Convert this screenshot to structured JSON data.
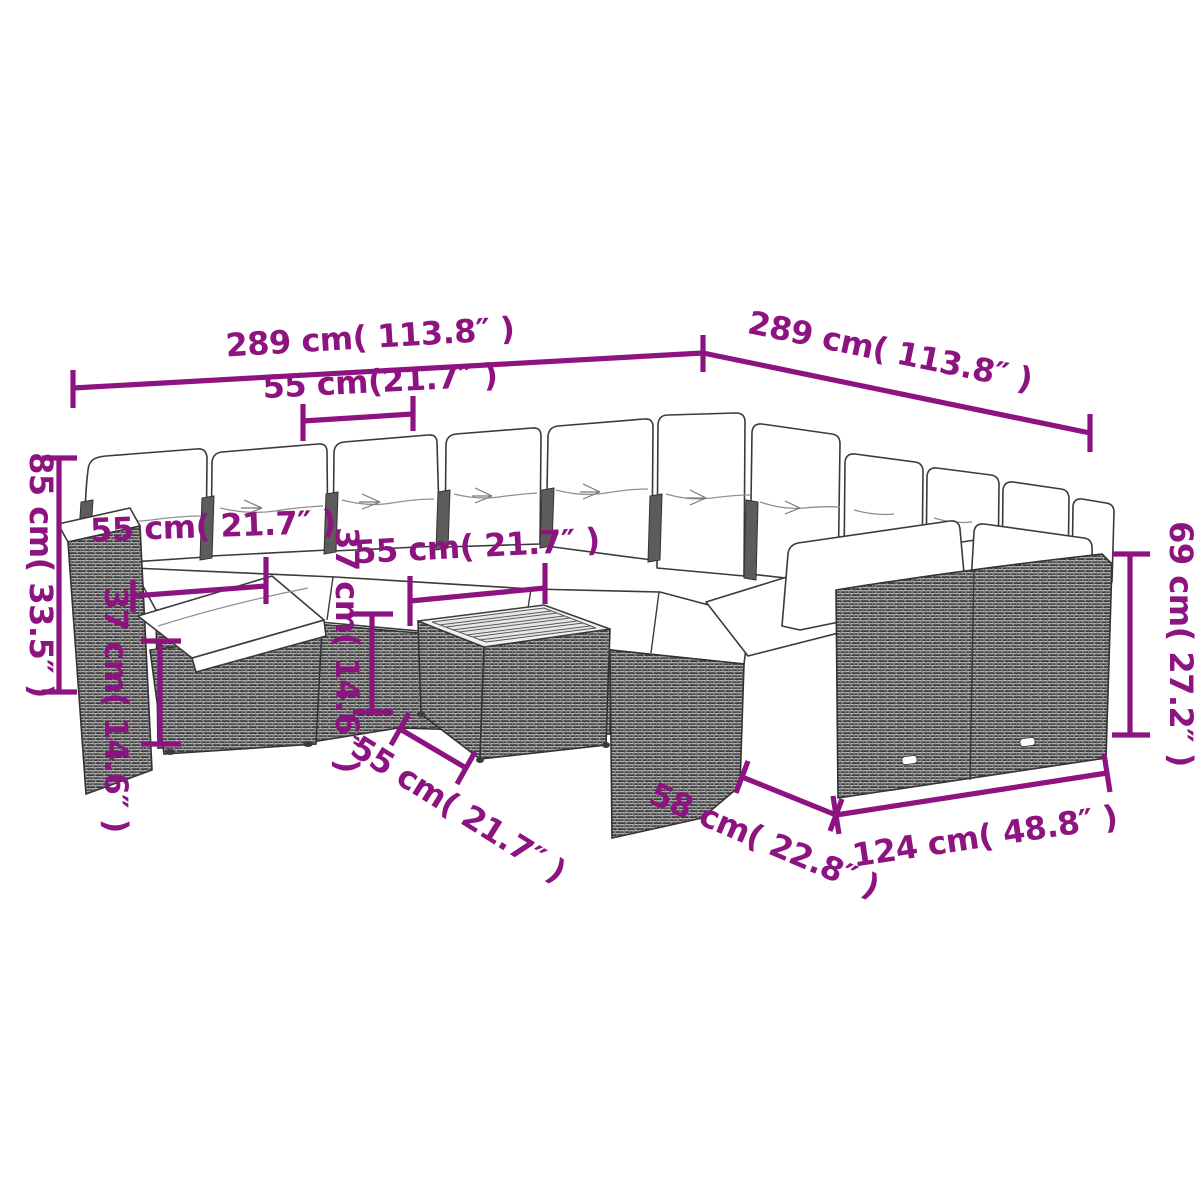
{
  "figure": {
    "type": "product dimension diagram",
    "subject": "12-piece rattan garden lounge sofa set with white cushions, ottoman and square coffee table",
    "background": "#FFFFFF"
  },
  "colors": {
    "annotation_purple": "#8D1380",
    "line_art": "#333333",
    "wicker_gray": "#8E8E8E",
    "cushion_white": "#FFFFFF"
  },
  "dimensions": [
    {
      "id": "overall-width-left",
      "label": "289 cm( 113.8″ )",
      "cm": 289,
      "inches": 113.8,
      "placement": "top left, along back row"
    },
    {
      "id": "overall-depth-right",
      "label": "289 cm( 113.8″ )",
      "cm": 289,
      "inches": 113.8,
      "placement": "top right, along right wing"
    },
    {
      "id": "seat-width-top",
      "label": "55 cm(21.7″ )",
      "cm": 55,
      "inches": 21.7,
      "placement": "top, single seat width"
    },
    {
      "id": "back-height-left",
      "label": "85 cm( 33.5″ )",
      "cm": 85,
      "inches": 33.5,
      "placement": "far left, vertical overall height"
    },
    {
      "id": "seat-width-left",
      "label": "55 cm( 21.7″ )",
      "cm": 55,
      "inches": 21.7,
      "placement": "left seat width"
    },
    {
      "id": "ottoman-height",
      "label": "37 cm( 14.6″ )",
      "cm": 37,
      "inches": 14.6,
      "placement": "vertical at ottoman"
    },
    {
      "id": "seat-width-middle",
      "label": "55 cm( 21.7″ )",
      "cm": 55,
      "inches": 21.7,
      "placement": "middle seat width"
    },
    {
      "id": "table-height",
      "label": "37 cm( 14.6″ )",
      "cm": 37,
      "inches": 14.6,
      "placement": "vertical at coffee table"
    },
    {
      "id": "table-width",
      "label": "55 cm( 21.7″ )",
      "cm": 55,
      "inches": 21.7,
      "placement": "slanted, coffee table width"
    },
    {
      "id": "wing-depth",
      "label": "58 cm( 22.8″ )",
      "cm": 58,
      "inches": 22.8,
      "placement": "slanted, right wing depth"
    },
    {
      "id": "wing-length",
      "label": "124 cm( 48.8″ )",
      "cm": 124,
      "inches": 48.8,
      "placement": "bottom right, right wing length"
    },
    {
      "id": "side-height-right",
      "label": "69 cm( 27.2″ )",
      "cm": 69,
      "inches": 27.2,
      "placement": "far right, vertical back height"
    }
  ]
}
